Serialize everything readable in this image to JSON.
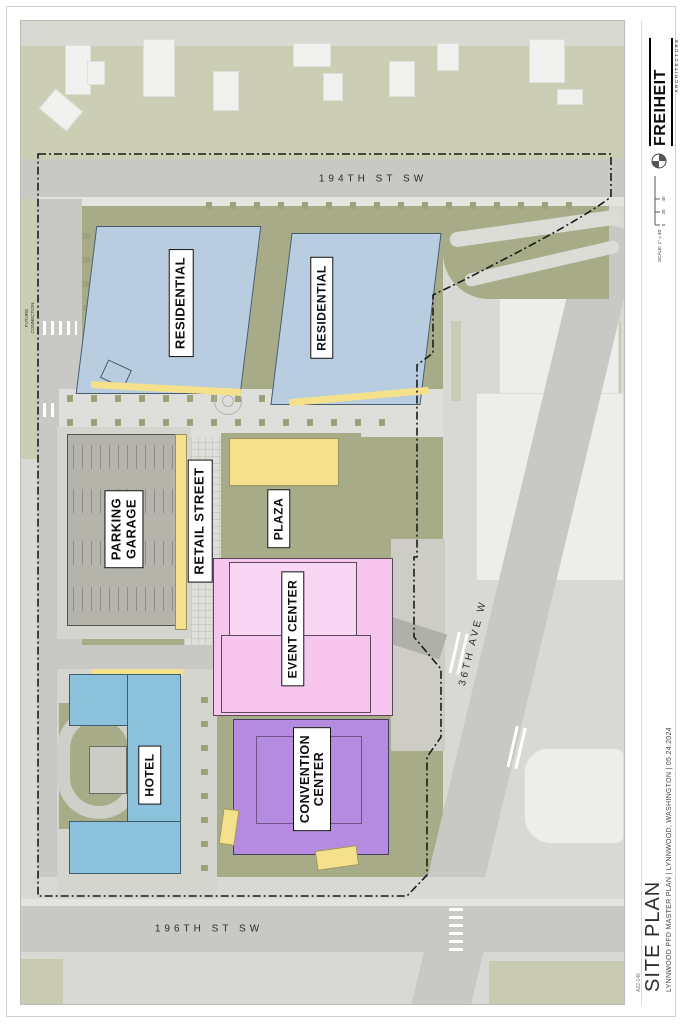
{
  "sheet": {
    "firm": "FREIHEIT",
    "firm_sub": "ARCHITECTURE",
    "scale_label": "SCALE: 1\" = 40'",
    "scale_ticks": [
      "0",
      "20",
      "40",
      "80"
    ],
    "title": "SITE PLAN",
    "subtitle": "LYNNWOOD PFD MASTER PLAN  |  LYNNWOOD, WASHINGTON  |  05.24.2024",
    "sheet_number": "A22-146"
  },
  "streets": {
    "north": "194TH ST SW",
    "south": "196TH ST SW",
    "east": "36TH AVE W"
  },
  "annotations": {
    "future_connection": "FUTURE\nCONNECTION"
  },
  "buildings": {
    "residential_a": {
      "label": "RESIDENTIAL",
      "color": "#b9cde1"
    },
    "residential_b": {
      "label": "RESIDENTIAL",
      "color": "#b9cde1"
    },
    "parking_garage": {
      "label": "PARKING\nGARAGE",
      "color": "#b4b4ab"
    },
    "retail_street": {
      "label": "RETAIL STREET",
      "color": "#f5e18c"
    },
    "plaza": {
      "label": "PLAZA",
      "color": "#f5e18c"
    },
    "event_center": {
      "label": "EVENT CENTER",
      "color": "#f7c6ef"
    },
    "convention_center": {
      "label": "CONVENTION\nCENTER",
      "color": "#b58be2"
    },
    "hotel": {
      "label": "HOTEL",
      "color": "#8cc1dc"
    }
  },
  "colors": {
    "site_landscape": "#a8ab88",
    "neighborhood": "#cbcdb5",
    "road": "#c8c8c5",
    "paving": "#dedfda",
    "page": "#ffffff",
    "boundary_line": "#1b1b1b"
  }
}
